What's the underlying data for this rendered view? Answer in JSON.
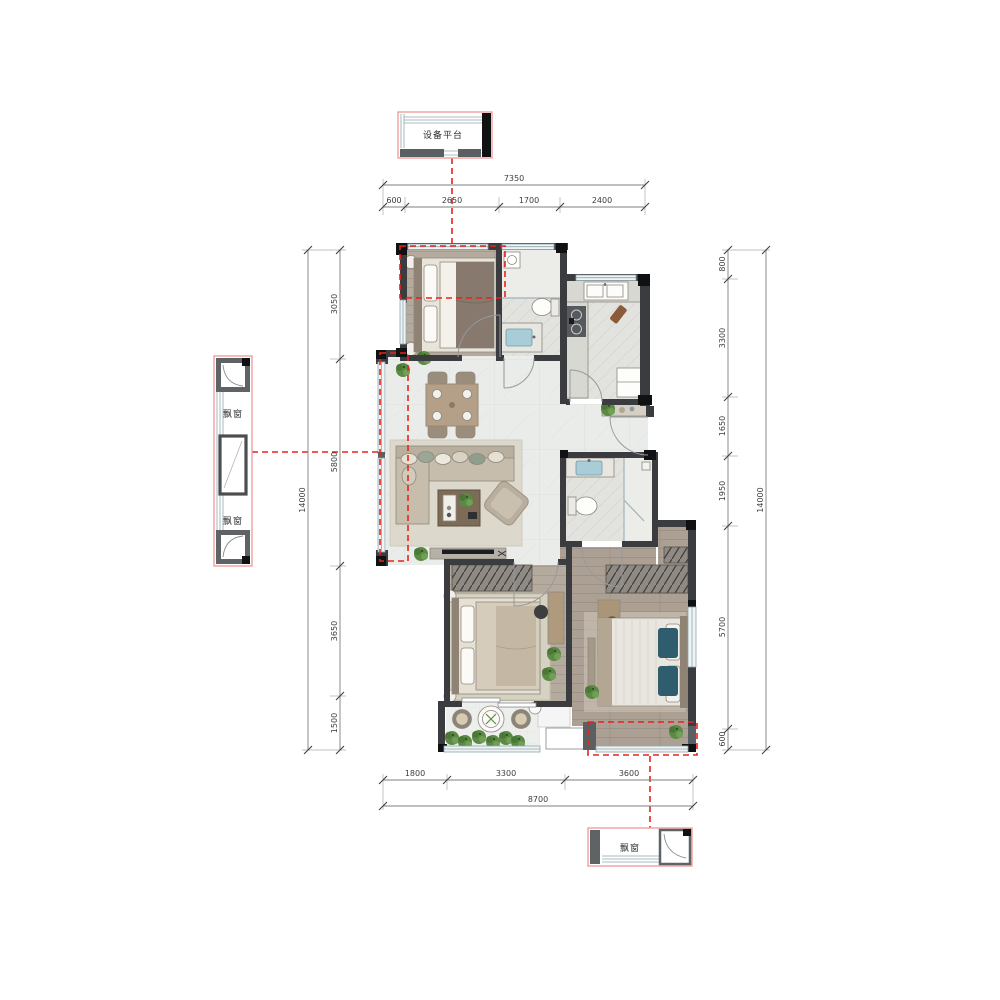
{
  "plan_title": "apartment-floor-plan",
  "colors": {
    "annotation_red": "#e8231b",
    "detail_border_pink": "#efa09e",
    "wall_dark": "#3a3c3f",
    "wood_floor": "#b5aa9e",
    "master_wood_floor": "#aca094",
    "tile_floor": "#e2e2de",
    "marble_floor": "#eaecea",
    "dim_line": "#7d8082",
    "dim_text": "#3b3d3f"
  },
  "details": {
    "equipment_platform_label": "设备平台",
    "left_bay_window_top_label": "飘窗",
    "left_bay_window_bottom_label": "飘窗",
    "bottom_bay_window_label": "飘窗"
  },
  "dimensions": {
    "top": {
      "total": "7350",
      "segments": [
        "600",
        "2650",
        "1700",
        "2400"
      ]
    },
    "left": {
      "total": "14000",
      "segments": [
        "3050",
        "5800",
        "3650",
        "1500"
      ]
    },
    "right": {
      "total": "14000",
      "segments": [
        "800",
        "3300",
        "1650",
        "1950",
        "5700",
        "600"
      ]
    },
    "bottom": {
      "total": "8700",
      "segments": [
        "1800",
        "3300",
        "3600"
      ]
    }
  }
}
